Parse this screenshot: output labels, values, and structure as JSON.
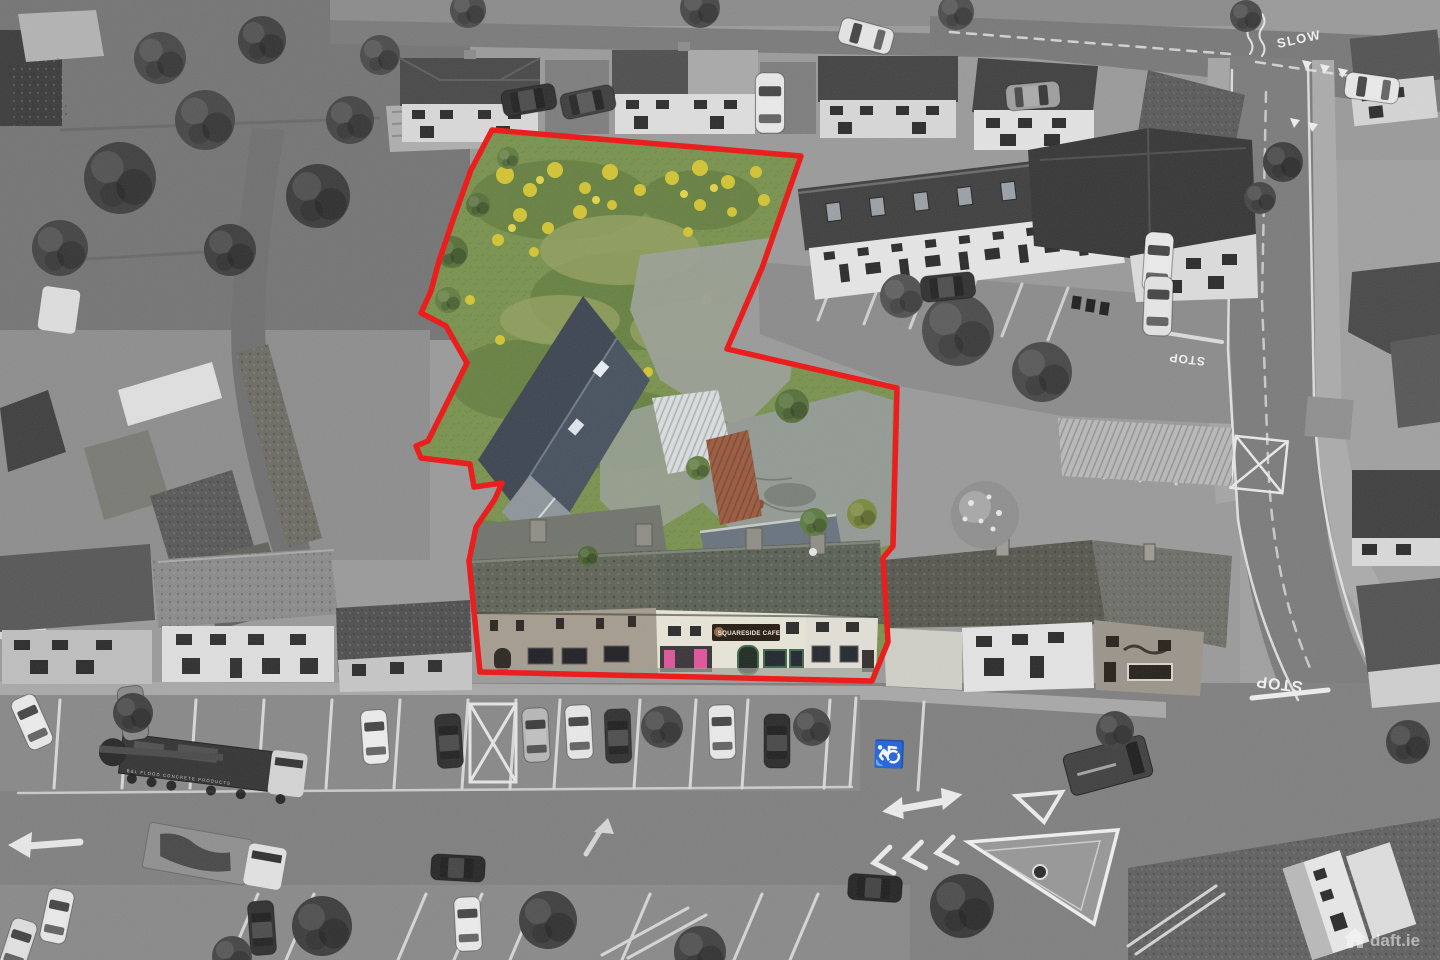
{
  "scene": {
    "type": "aerial-drone-photograph",
    "description": "Greyscale aerial photograph of a town centre; a development site (overgrown field, stone outbuildings, courtyard and street-front terrace with cafe) is shown in colour and outlined in red. Streets with parked cars, a flatbed truck, road markings and junctions surround it.",
    "effects": [
      "greyscale-surroundings",
      "colour-highlighted-site",
      "red-boundary-outline",
      "film-grain"
    ]
  },
  "boundary": {
    "color": "#ee1414",
    "stroke_width": 5.5
  },
  "road_markings": {
    "slow": "SLOW",
    "stop_upper": "STOP",
    "stop_lower": "STOP",
    "disabled_symbol": "♿"
  },
  "site": {
    "cafe_sign": "SQUARESIDE CAFE",
    "colors": {
      "grass": "#79924e",
      "wildflowers": "#d3c433",
      "slate_roof": "#46515e",
      "rust_roof": "#9b5a3d",
      "shopfront_pink": "#e0549a",
      "shopfront_green": "#3f6648",
      "moss_roof": "#5a6054"
    }
  },
  "vehicles": {
    "truck_livery": "B&L FLOOD CONCRETE PRODUCTS"
  },
  "watermark": {
    "label": "daft.ie",
    "icon": "house-icon",
    "color": "#ffffff",
    "opacity": 0.55
  }
}
